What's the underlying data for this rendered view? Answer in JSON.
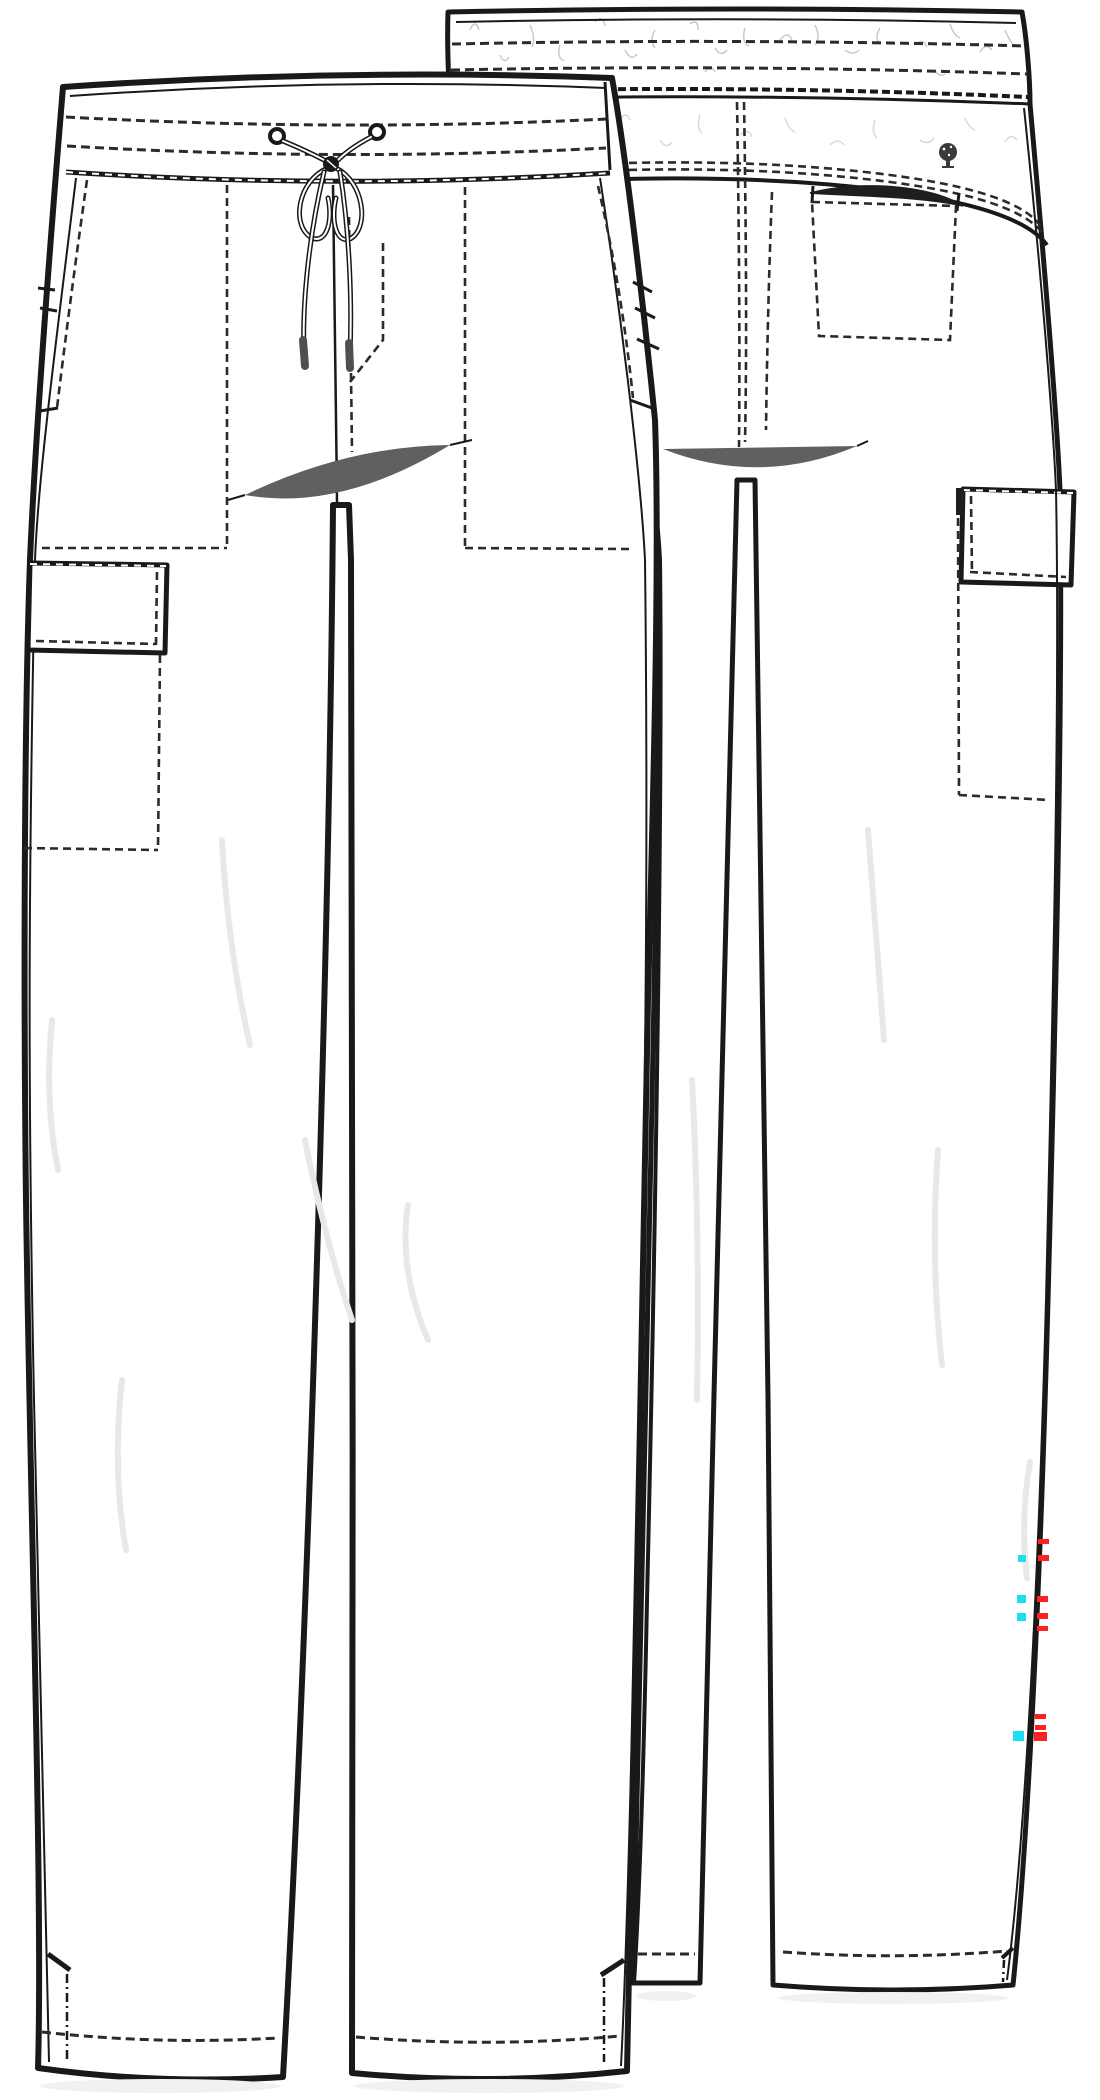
{
  "page": {
    "background": "#ffffff",
    "width": 1100,
    "height": 2100
  },
  "illustration": {
    "kind": "apparel-technical-flat-sketch",
    "garment": "drawstring cargo pants",
    "views": [
      {
        "id": "front",
        "label": "front view"
      },
      {
        "id": "back",
        "label": "back view"
      }
    ],
    "features": [
      "knit waistband with double topstitching",
      "center-front drawstring bow with metal-tipped cords",
      "front slash pockets",
      "left-leg cargo pocket",
      "curved back yoke with double topstitching",
      "back welt pocket",
      "right-leg back cargo pocket",
      "side hem vents"
    ]
  },
  "logo": {
    "name": "tree-logo",
    "color": "#3a3a3a"
  },
  "colors": {
    "line": "#191919",
    "stitch": "#2b2b2b",
    "crotch_shade": "#606060",
    "fold_shade": "#e8e8e8",
    "hem_shadow": "#f1f1f1",
    "waistband_texture": "#c9c9c9",
    "drawcord_tip": "#4f4f4f",
    "red_mark": "#ff2121",
    "cyan_mark": "#1ddff2"
  },
  "annotation_marks": {
    "red_ticks": [
      {
        "x": 1038,
        "y": 1539,
        "w": 11,
        "h": 5
      },
      {
        "x": 1038,
        "y": 1555,
        "w": 11,
        "h": 6
      },
      {
        "x": 1037,
        "y": 1596,
        "w": 11,
        "h": 6
      },
      {
        "x": 1037,
        "y": 1613,
        "w": 11,
        "h": 6
      },
      {
        "x": 1037,
        "y": 1626,
        "w": 11,
        "h": 5
      },
      {
        "x": 1035,
        "y": 1714,
        "w": 11,
        "h": 5
      },
      {
        "x": 1035,
        "y": 1725,
        "w": 11,
        "h": 5
      },
      {
        "x": 1034,
        "y": 1732,
        "w": 13,
        "h": 9
      }
    ],
    "cyan_squares": [
      {
        "x": 1018,
        "y": 1555,
        "w": 8,
        "h": 7
      },
      {
        "x": 1017,
        "y": 1595,
        "w": 9,
        "h": 8
      },
      {
        "x": 1017,
        "y": 1613,
        "w": 9,
        "h": 8
      },
      {
        "x": 1013,
        "y": 1731,
        "w": 11,
        "h": 10
      }
    ]
  }
}
